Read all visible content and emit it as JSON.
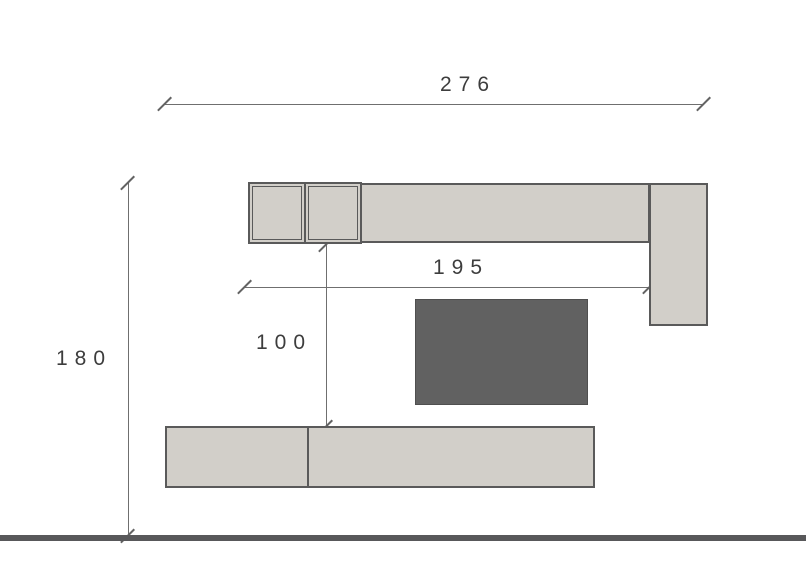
{
  "drawing": {
    "title": "wall-unit-elevation",
    "dimensions": {
      "total_width": {
        "label": "276"
      },
      "total_height": {
        "label": "180"
      },
      "upper_run_width": {
        "label": "195"
      },
      "gap_height": {
        "label": "100"
      }
    },
    "components": [
      {
        "name": "wall-cabinet-framed-1"
      },
      {
        "name": "wall-cabinet-framed-2"
      },
      {
        "name": "wall-cabinet-long"
      },
      {
        "name": "tall-side-cabinet"
      },
      {
        "name": "tv-panel"
      },
      {
        "name": "tv-bench-two-sections"
      },
      {
        "name": "floor-line"
      }
    ],
    "colors": {
      "cabinet_fill": "#d2cfc9",
      "cabinet_border": "#5a5a5a",
      "tv_fill": "#616161",
      "tv_border": "#4f4f4f",
      "floor": "#58585a",
      "dimension_line": "#6f6f6f",
      "dimension_text": "#3d3d3d",
      "background": "#ffffff"
    }
  }
}
